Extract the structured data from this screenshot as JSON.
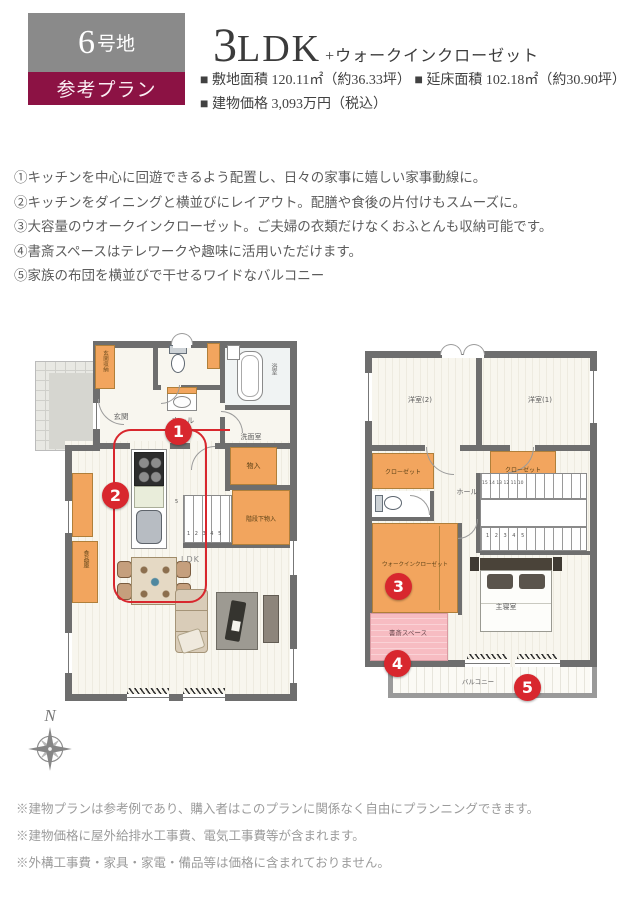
{
  "header": {
    "lot_number": "6",
    "lot_suffix": "号地",
    "plan_label": "参考プラン",
    "title_number": "3",
    "title_letters": "LDK",
    "title_plus": "+ウォークインクローゼット",
    "spec_site": "■ 敷地面積 120.11㎡（約36.33坪）",
    "spec_floor": "■ 延床面積 102.18㎡（約30.90坪）",
    "spec_price": "■ 建物価格 3,093万円（税込）"
  },
  "features": [
    "①キッチンを中心に回遊できるよう配置し、日々の家事に嬉しい家事動線に。",
    "②キッチンをダイニングと横並びにレイアウト。配膳や食後の片付けもスムーズに。",
    "③大容量のウオークインクローゼット。ご夫婦の衣類だけなくおふとんも収納可能です。",
    "④書斎スペースはテレワークや趣味に活用いただけます。",
    "⑤家族の布団を横並びで干せるワイドなバルコニー"
  ],
  "floor1": {
    "labels": {
      "entrance_storage": "玄関収納",
      "entrance": "玄関",
      "hall": "ホール",
      "bath": "浴室",
      "washroom": "洗面室",
      "storage": "物入",
      "understairs": "階段下物入",
      "pantry": "食品庫",
      "ldk": "LDK",
      "stair_numbers": "1 2 3 4 5",
      "stair_mark": "5"
    },
    "markers": {
      "m1": "1",
      "m2": "2"
    }
  },
  "floor2": {
    "labels": {
      "bedroom2": "洋室(2)",
      "bedroom1": "洋室(1)",
      "closet_left": "クローゼット",
      "closet_right": "クローゼット",
      "hall": "ホール",
      "wic": "ウォークインクローゼット",
      "study": "書斎スペース",
      "master": "主寝室",
      "balcony": "バルコニー",
      "stair_upper": "15 14 13 12 11 10",
      "stair_lower": "1 2 3 4 5"
    },
    "markers": {
      "m3": "3",
      "m4": "4",
      "m5": "5"
    }
  },
  "compass": {
    "label": "N"
  },
  "notes": [
    "※建物プランは参考例であり、購入者はこのプランに関係なく自由にプランニングできます。",
    "※建物価格に屋外給排水工事費、電気工事費等が含まれます。",
    "※外構工事費・家具・家電・備品等は価格に含まれておりません。"
  ],
  "colors": {
    "badge_gray": "#8a8a8a",
    "badge_maroon": "#8c1244",
    "marker_red": "#d8272e",
    "plan_orange": "#f2a55e",
    "study_pink": "#f7bcc2",
    "wall_gray": "#6e6e6e"
  }
}
